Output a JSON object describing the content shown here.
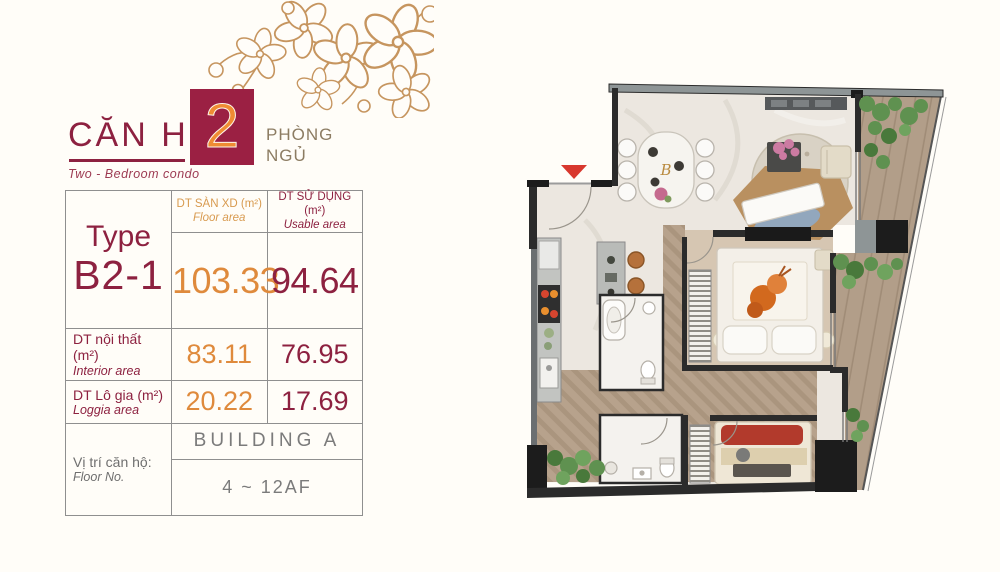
{
  "title": {
    "vi": "CĂN HỘ",
    "number": "2",
    "suffix": [
      "PHÒNG",
      "NGỦ"
    ],
    "en": "Two - Bedroom condo"
  },
  "spec_table": {
    "type": {
      "label": "Type",
      "value": "B2-1"
    },
    "headers": {
      "floor": {
        "vi": "DT SÀN XD (m²)",
        "en": "Floor area"
      },
      "usable": {
        "vi": "DT SỬ DỤNG (m²)",
        "en": "Usable area"
      }
    },
    "main": {
      "floor": "103.33",
      "usable": "94.64"
    },
    "interior": {
      "vi": "DT nội thất (m²)",
      "en": "Interior area",
      "floor": "83.11",
      "usable": "76.95"
    },
    "loggia": {
      "vi": "DT Lô gia (m²)",
      "en": "Loggia area",
      "floor": "20.22",
      "usable": "17.69"
    },
    "location": {
      "vi": "Vị trí căn hộ:",
      "en": "Floor No.",
      "building": "BUILDING A",
      "floors": "4 ~ 12AF"
    }
  },
  "floor_plan": {
    "monogram": "B"
  },
  "colors": {
    "maroon": "#8d2140",
    "orange_value": "#df8a3c",
    "orange_header": "#d89a4f",
    "badge_bg": "#9b2043",
    "badge_number": "#ef8c33",
    "gold_blossom": "#c6955f",
    "gray_text": "#7b7b7b",
    "wall": "#2b2b2b",
    "wood_floor": "#b7a28c",
    "plant_green": "#5f9150",
    "entry_arrow_red": "#d8382e"
  }
}
